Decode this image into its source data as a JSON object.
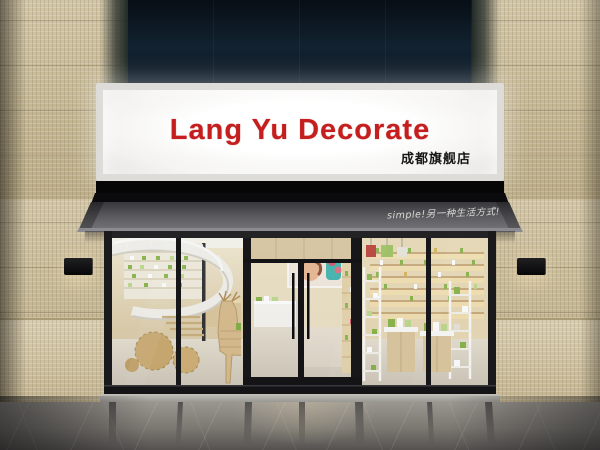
{
  "scene": {
    "description": "3D render of a cosmetics shop storefront with backlit signboard, dark awning, glass facade and marble floor"
  },
  "sign": {
    "title": "Lang Yu Decorate",
    "subtitle": "成都旗舰店",
    "title_color": "#c41e1e",
    "subtitle_color": "#161616",
    "panel_color": "#f7f6f3"
  },
  "awning": {
    "slogan": "simple!另一种生活方式!",
    "slogan_color": "#dcdad6",
    "fabric_color": "#55555a"
  },
  "palette": {
    "top_wall_navy": "#122230",
    "mosaic_tile_beige": "#c7ba98",
    "window_frame": "#17171a",
    "interior_warm_wood": "#d9c49c",
    "product_green": "#86b344",
    "marble_floor_gray": "#7b7872"
  }
}
